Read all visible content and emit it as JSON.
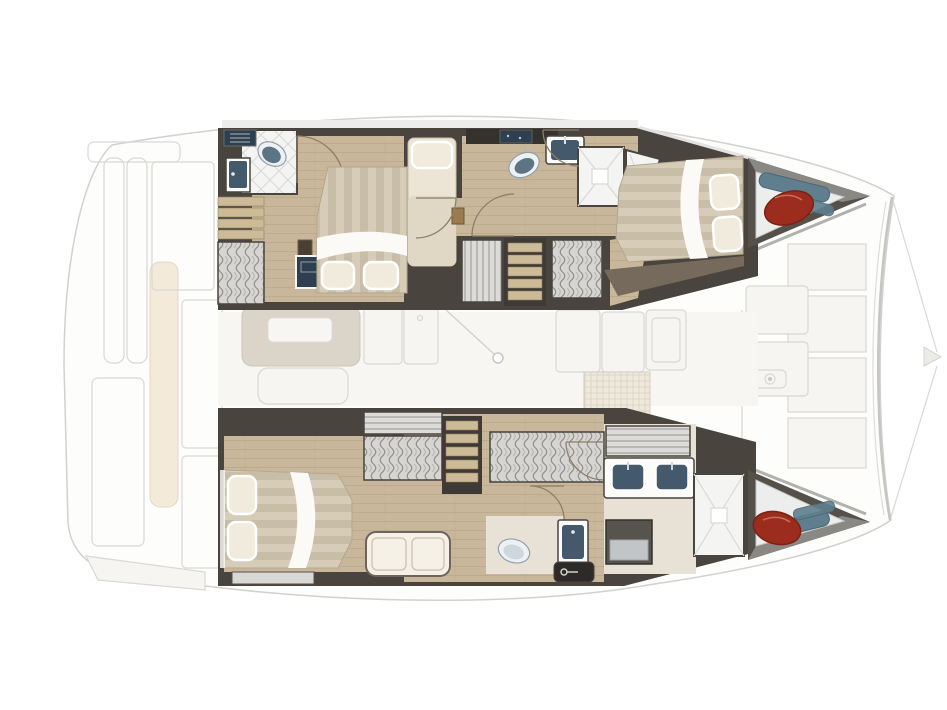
{
  "title": "Catamaran interior deck plan — overhead cabin layout",
  "vessel": {
    "type": "sailing catamaran",
    "view": "top-down interior floor plan",
    "bow_direction": "right",
    "stern_direction": "left",
    "hull_count": 2
  },
  "colors": {
    "hullFill": "#fdfdfc",
    "hullStroke": "#d2d1cf",
    "deckStrip": "#ededeb",
    "fadeFill": "#f6f5f2",
    "fadeStroke": "#d9d8d4",
    "creamCushion": "#f3ead9",
    "wall": "#49443e",
    "wallLight": "#55504a",
    "wood": "#c9b79c",
    "paleWood": "#e8e2d6",
    "tile": "#f4f4f2",
    "tileLine": "#d9d9d5",
    "bedStripeA": "#d6ccb8",
    "bedStripeB": "#c8bda7",
    "bedWhite": "#fbfaf7",
    "pillow": "#f1ebdd",
    "navy": "#44596c",
    "navyDeep": "#2e4050",
    "toiletRim": "#eef1f3",
    "toiletSeat": "#5d7485",
    "lockerGray": "#d7d6d3",
    "stepWood": "#cdbb97",
    "fenderRed": "#9c2c1e",
    "fenderRedDark": "#7e2014",
    "fenderBlue": "#5f7f8e",
    "storageFloor": "#eceded",
    "storageShade": "#8a8884",
    "benchCream": "#f5f1e6",
    "salonTable": "#dbd4c9"
  },
  "hulls": {
    "port_top": {
      "position": "top hull",
      "rooms": [
        {
          "name": "aft head",
          "items": [
            "toilet",
            "washbasin vanity",
            "vent counter",
            "tiled floor",
            "door swing"
          ]
        },
        {
          "name": "aft cabin",
          "items": [
            "double bed",
            "two pillows",
            "white duvet fold",
            "nightstand",
            "tv cabinet",
            "hanging locker",
            "steps"
          ]
        },
        {
          "name": "midship berth",
          "items": [
            "single berth",
            "pillow",
            "storage box"
          ]
        },
        {
          "name": "midship head",
          "items": [
            "toilet",
            "washbasin",
            "dark counter",
            "shower with drain",
            "door swings"
          ]
        },
        {
          "name": "companionway",
          "items": [
            "stairs to salon",
            "louvered locker",
            "hanging locker"
          ]
        },
        {
          "name": "forward cabin",
          "items": [
            "double bed",
            "two pillows",
            "white duvet fold"
          ]
        },
        {
          "name": "bow locker",
          "items": [
            "red fender",
            "blue fenders"
          ]
        }
      ]
    },
    "starboard_bottom": {
      "position": "bottom hull",
      "rooms": [
        {
          "name": "aft cabin",
          "items": [
            "double bed",
            "two pillows",
            "white duvet fold",
            "storage panel"
          ]
        },
        {
          "name": "companionway",
          "items": [
            "stairs to salon",
            "hanging locker",
            "wide hanging locker",
            "louvered hatch",
            "settee bench"
          ]
        },
        {
          "name": "midship wc",
          "items": [
            "toilet",
            "small washbasin vanity",
            "dark counter with handle",
            "door swing"
          ]
        },
        {
          "name": "forward head",
          "items": [
            "double washbasin vanity",
            "louvered locker",
            "appliance cabinet",
            "shower with drain"
          ]
        },
        {
          "name": "bow locker",
          "items": [
            "red fender",
            "blue fenders"
          ]
        }
      ]
    }
  },
  "salon": {
    "faded": true,
    "items": [
      "dinette table",
      "sofa seat",
      "galley unit",
      "sink unit",
      "cabinet units",
      "woven mat",
      "mast foot with rigging line"
    ]
  },
  "foredeck": {
    "faded": true,
    "items": [
      "deck hatches",
      "windlass",
      "forward platform panels",
      "curved crossbeam",
      "bowsprit rigging lines"
    ]
  },
  "stern_deck": {
    "faded": true,
    "items": [
      "transom rail",
      "cockpit pillars",
      "bench cushion",
      "deck panels",
      "swim step"
    ]
  }
}
